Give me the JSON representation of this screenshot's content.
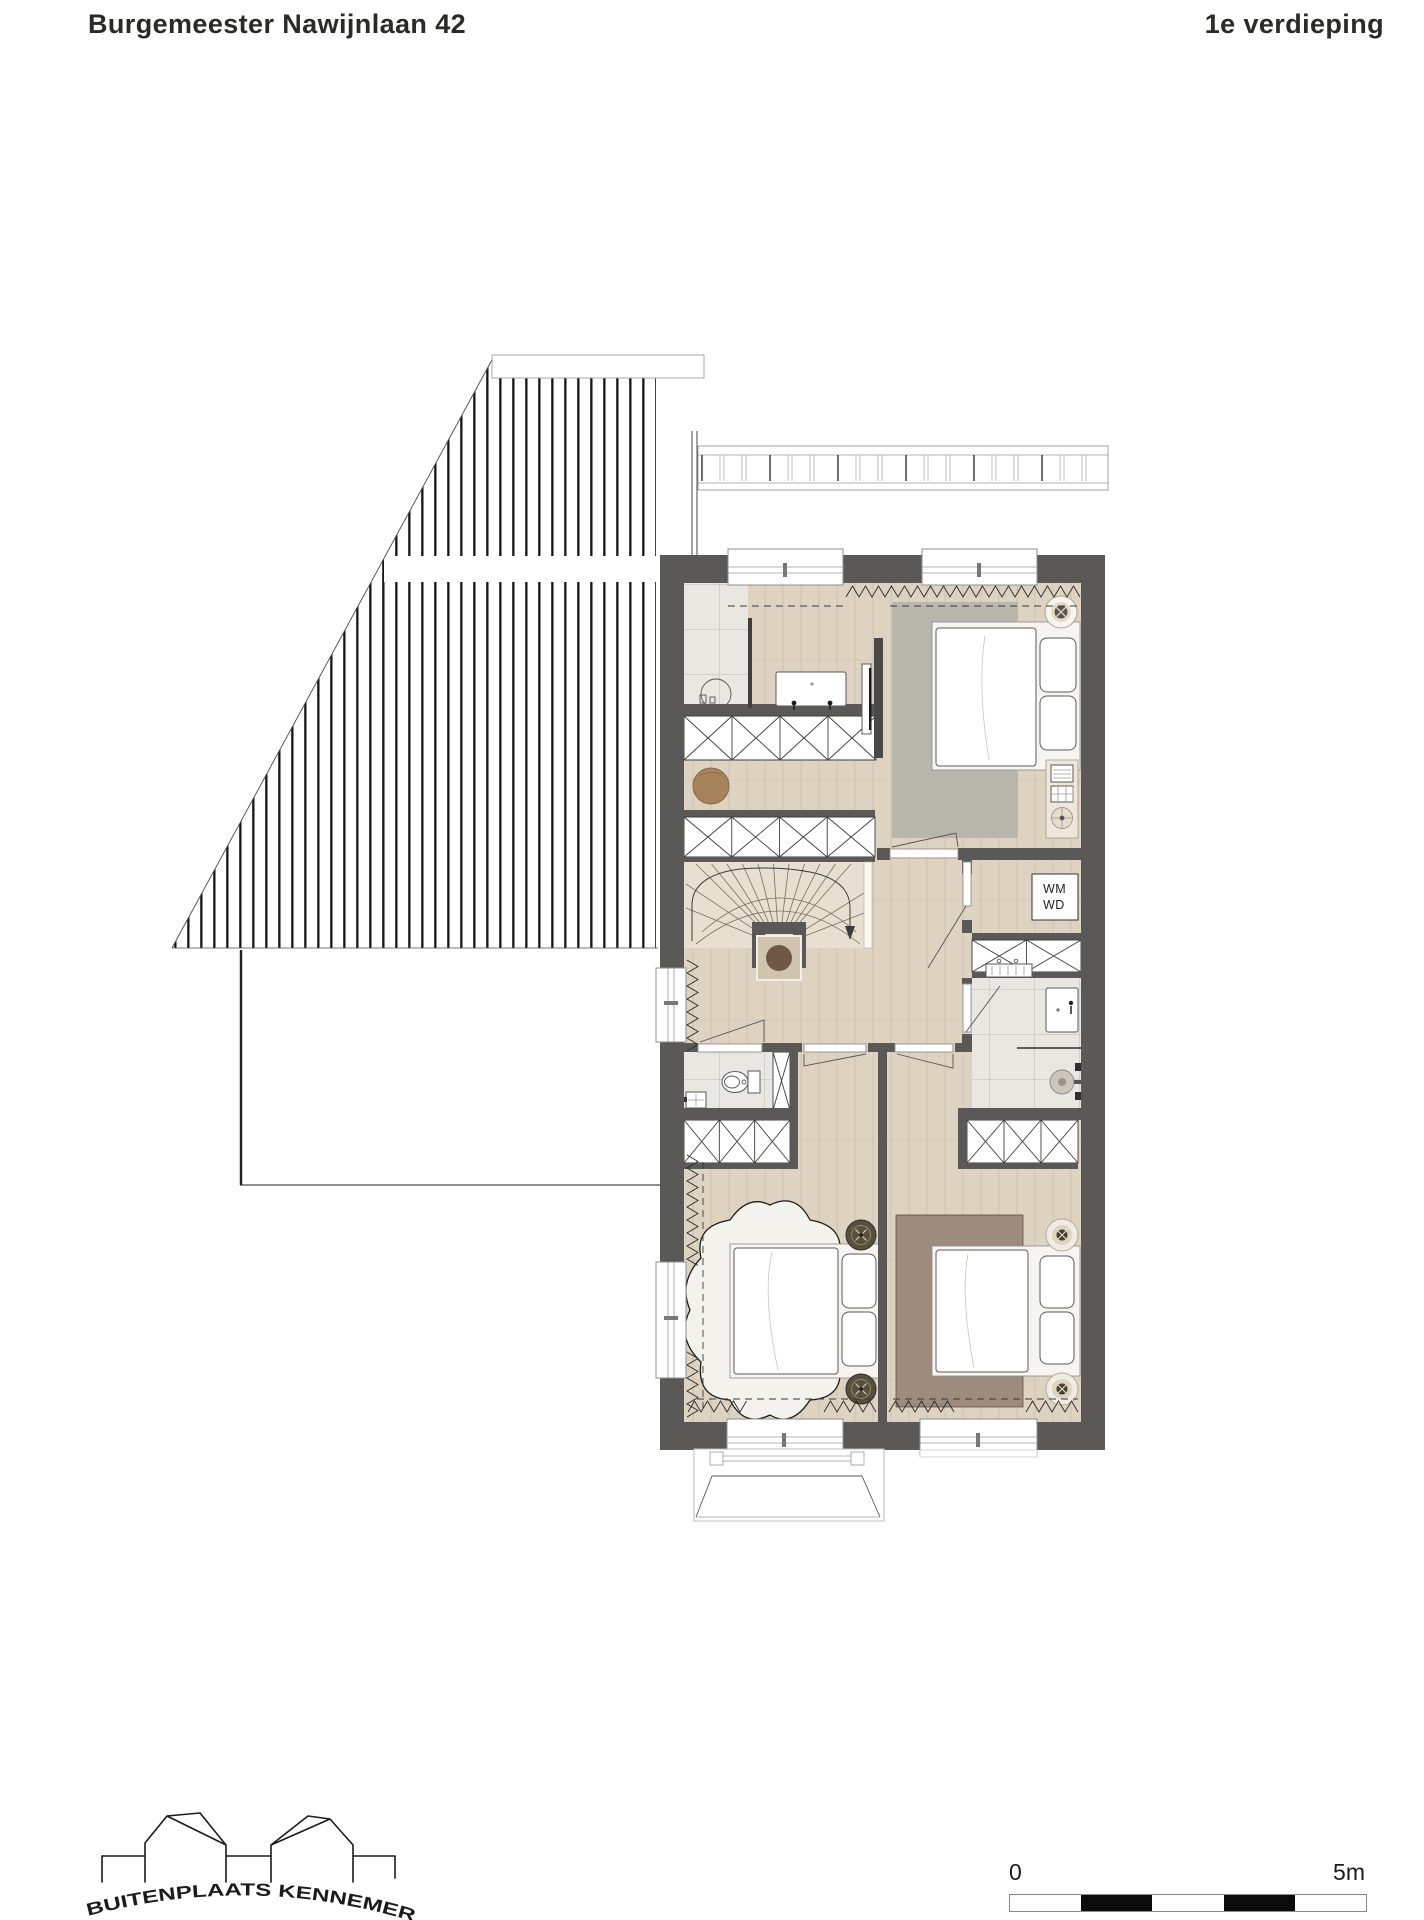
{
  "header": {
    "title": "Burgemeester Nawijnlaan 42",
    "floor_label": "1e verdieping"
  },
  "plan": {
    "wm_label": "WM",
    "wd_label": "WD"
  },
  "scale_bar": {
    "start_label": "0",
    "end_label": "5m"
  },
  "logo": {
    "text": "BUITENPLAATS KENNEMER"
  },
  "colors": {
    "ink": "#2b2a28",
    "wall": "#5a5957",
    "wood": "#ded2c1",
    "tile": "#e9e7e2",
    "stair_floor": "#e9dfd0",
    "rug_master": "#b9b7ab",
    "rug_brown": "#9d8b7e",
    "sheepskin": "#f4f2ed",
    "stool": "#a7835c",
    "plant": "#6f5945",
    "planter": "#d0c4af"
  }
}
